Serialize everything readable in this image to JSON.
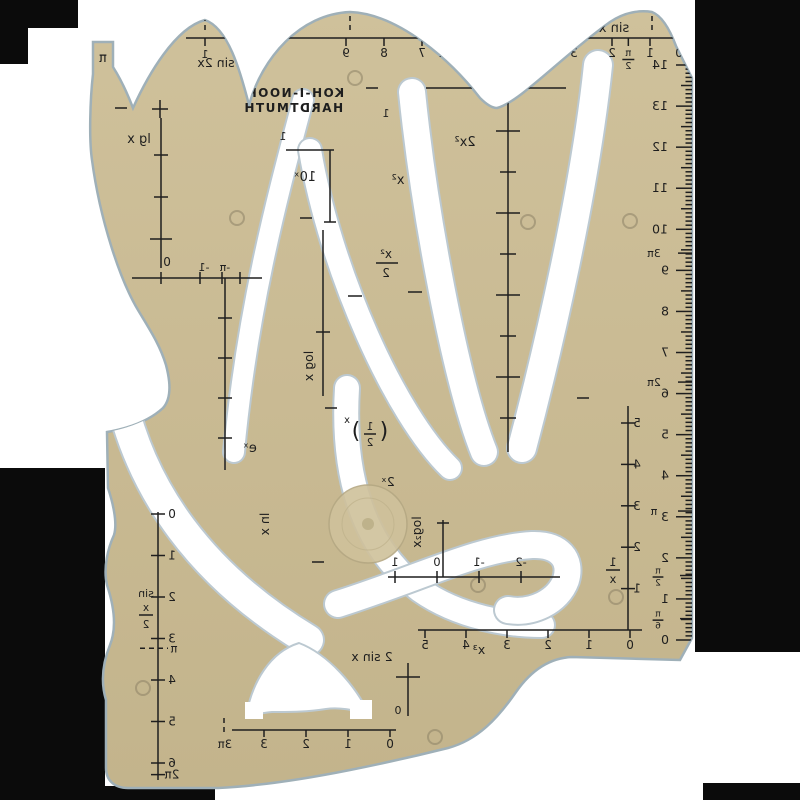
{
  "brand": {
    "line1": "KOH-I-NOOR",
    "line2": "HARDTMUTH"
  },
  "curve_labels": {
    "sin_x": "sin x",
    "sin_2x": "sin 2x",
    "two_sin_x": "2 sin x",
    "sin_half_top": "sin",
    "sin_half_num": "x",
    "sin_half_den": "2",
    "lg_x": "lg x",
    "ten_x": "10ˣ",
    "log_x": "log x",
    "e_x": "eˣ",
    "ln_x": "ln x",
    "x_sq": "x²",
    "two_x_sq": "2x²",
    "x_sq_half_num": "x²",
    "x_sq_half_den": "2",
    "half_x_num": "1",
    "half_x_den": "2",
    "half_x_exp": "x",
    "paren_open": "(",
    "paren_close": ")",
    "two_x": "2ˣ",
    "log2_x": "log₂x",
    "inv_num": "1",
    "inv_den": "x",
    "x_cubed": "x³",
    "pi_tab": "π"
  },
  "top_scale": {
    "labels": [
      {
        "t": "0",
        "u": 0
      },
      {
        "t": "1",
        "u": 1
      },
      {
        "t": "π/2",
        "u": 1.57,
        "frac": true,
        "num": "π",
        "den": "2"
      },
      {
        "t": "2",
        "u": 2
      },
      {
        "t": "3",
        "u": 3
      },
      {
        "t": "π",
        "u": 3.32
      },
      {
        "t": "2π",
        "u": 6.35
      },
      {
        "t": "7",
        "u": 7
      },
      {
        "t": "8",
        "u": 8
      },
      {
        "t": "9",
        "u": 9
      }
    ],
    "sin2x_zero": "0",
    "sin2x_one": "1"
  },
  "ruler": {
    "marks": [
      {
        "v": 0,
        "t": "0",
        "kind": "cm"
      },
      {
        "v": 0.52,
        "num": "π",
        "den": "6",
        "kind": "pifrac"
      },
      {
        "v": 1,
        "t": "1",
        "kind": "cm"
      },
      {
        "v": 1.57,
        "num": "π",
        "den": "2",
        "kind": "pifrac"
      },
      {
        "v": 2,
        "t": "2",
        "kind": "cm"
      },
      {
        "v": 3,
        "t": "3",
        "kind": "cm"
      },
      {
        "v": 3.14,
        "t": "π",
        "kind": "pi"
      },
      {
        "v": 4,
        "t": "4",
        "kind": "cm"
      },
      {
        "v": 5,
        "t": "5",
        "kind": "cm"
      },
      {
        "v": 6,
        "t": "6",
        "kind": "cm"
      },
      {
        "v": 6.28,
        "t": "2π",
        "kind": "pi"
      },
      {
        "v": 7,
        "t": "7",
        "kind": "cm"
      },
      {
        "v": 8,
        "t": "8",
        "kind": "cm"
      },
      {
        "v": 9,
        "t": "9",
        "kind": "cm"
      },
      {
        "v": 9.42,
        "t": "3π",
        "kind": "pi"
      },
      {
        "v": 10,
        "t": "10",
        "kind": "cm"
      },
      {
        "v": 11,
        "t": "11",
        "kind": "cm"
      },
      {
        "v": 12,
        "t": "12",
        "kind": "cm"
      },
      {
        "v": 13,
        "t": "13",
        "kind": "cm"
      },
      {
        "v": 14,
        "t": "14",
        "kind": "cm"
      }
    ]
  },
  "left_scale": {
    "labels": [
      {
        "t": "0",
        "v": 0
      },
      {
        "t": "1",
        "v": 1
      },
      {
        "t": "2",
        "v": 2
      },
      {
        "t": "3",
        "v": 3
      },
      {
        "t": "π",
        "v": 3.14,
        "dashed": true
      },
      {
        "t": "4",
        "v": 4
      },
      {
        "t": "5",
        "v": 5
      },
      {
        "t": "6",
        "v": 6
      },
      {
        "t": "2π",
        "v": 6.28
      }
    ]
  },
  "inv_scale": {
    "h": [
      "0",
      "1",
      "2",
      "3",
      "4",
      "5"
    ],
    "v": [
      "1",
      "2",
      "3",
      "4",
      "5"
    ]
  },
  "log2_scale": [
    "1",
    "0",
    "-1",
    "-2"
  ],
  "hump_scale": {
    "nums": [
      "0",
      "1",
      "2",
      "3"
    ],
    "pi_mark": "3π"
  },
  "neg_scale": [
    "0",
    "-1",
    "-π"
  ],
  "misc": {
    "zero_cross": "0",
    "one_10x": "1",
    "one_sq": "1"
  },
  "colors": {
    "body": "#c9ba93",
    "body_light": "#d3c5a0",
    "engraving": "#1e1e1e",
    "background": "#ffffff",
    "border_black": "#0b0b0b",
    "slot_edge": "#bcc9d1",
    "milled_circle": "#cfc19b"
  }
}
